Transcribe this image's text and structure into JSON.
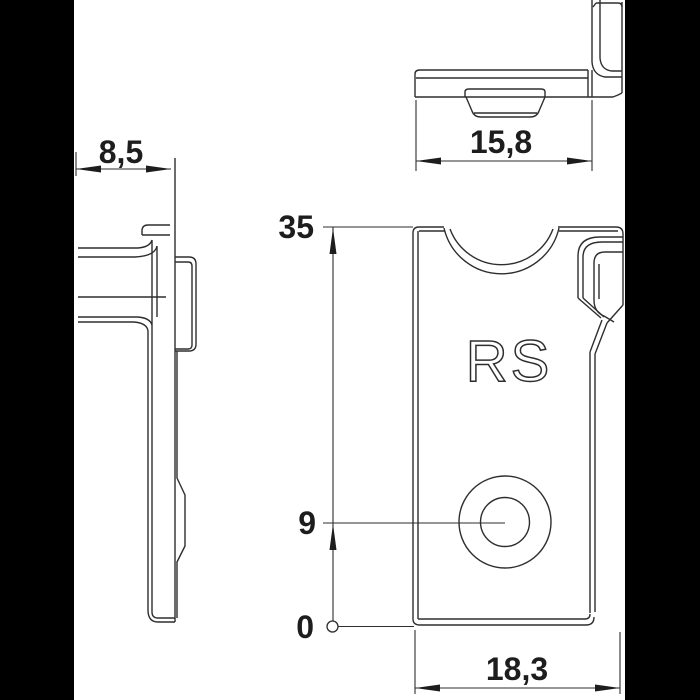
{
  "drawing": {
    "part_marking": "RS",
    "dimensions": {
      "side_depth": "8,5",
      "top_width": "15,8",
      "total_height": "35",
      "hole_center_height": "9",
      "baseline": "0",
      "front_width": "18,3"
    },
    "colors": {
      "line": "#2e2e2e",
      "background": "#ffffff",
      "side_bars": "#000000"
    }
  }
}
